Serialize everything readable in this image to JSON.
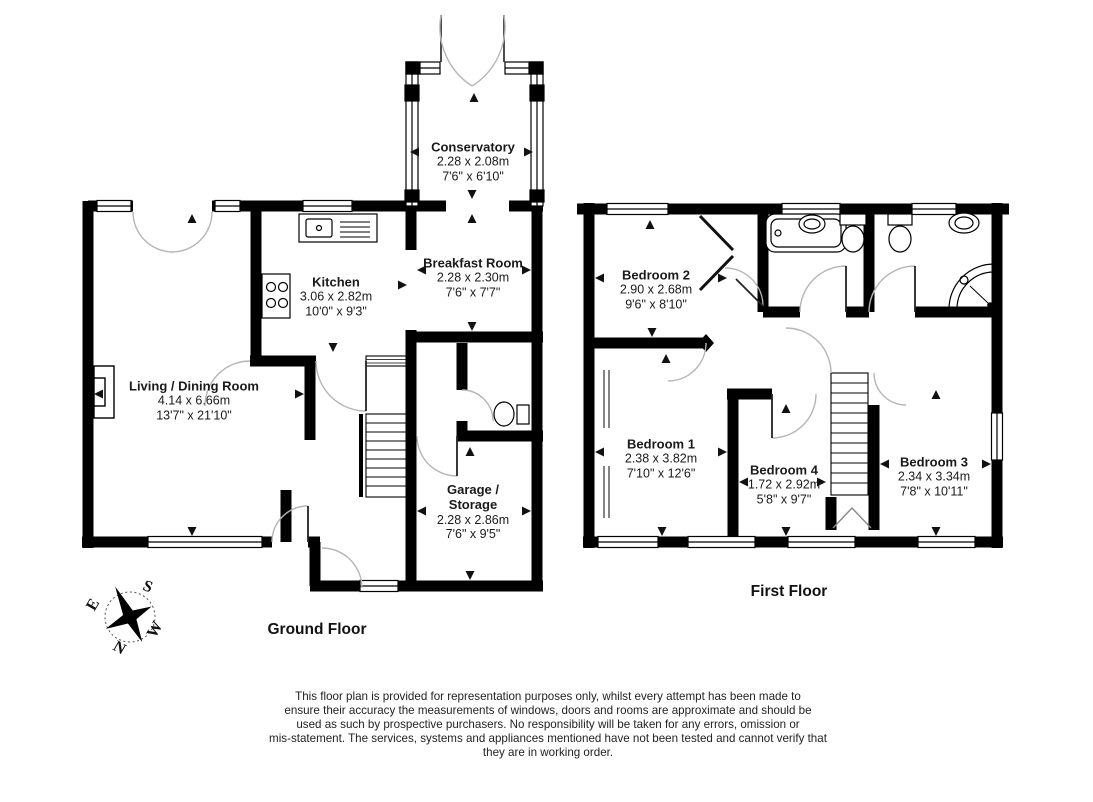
{
  "ground_floor": {
    "label": "Ground Floor",
    "rooms": {
      "living": {
        "name": "Living / Dining Room",
        "metric": "4.14 x 6.66m",
        "imperial": "13'7\" x 21'10\""
      },
      "kitchen": {
        "name": "Kitchen",
        "metric": "3.06 x 2.82m",
        "imperial": "10'0\" x 9'3\""
      },
      "breakfast": {
        "name": "Breakfast Room",
        "metric": "2.28 x 2.30m",
        "imperial": "7'6\" x 7'7\""
      },
      "conservatory": {
        "name": "Conservatory",
        "metric": "2.28 x 2.08m",
        "imperial": "7'6\" x 6'10\""
      },
      "garage": {
        "name": "Garage /\nStorage",
        "metric": "2.28 x 2.86m",
        "imperial": "7'6\" x 9'5\""
      }
    }
  },
  "first_floor": {
    "label": "First Floor",
    "rooms": {
      "bedroom1": {
        "name": "Bedroom 1",
        "metric": "2.38 x 3.82m",
        "imperial": "7'10\" x 12'6\""
      },
      "bedroom2": {
        "name": "Bedroom 2",
        "metric": "2.90 x 2.68m",
        "imperial": "9'6\" x 8'10\""
      },
      "bedroom3": {
        "name": "Bedroom 3",
        "metric": "2.34 x 3.34m",
        "imperial": "7'8\" x 10'11\""
      },
      "bedroom4": {
        "name": "Bedroom 4",
        "metric": "1.72 x 2.92m",
        "imperial": "5'8\" x 9'7\""
      }
    }
  },
  "compass": {
    "north": "N",
    "south": "S",
    "east": "E",
    "west": "W"
  },
  "disclaimer": "This floor plan is provided for representation purposes only, whilst every attempt has been made to\nensure their accuracy the measurements of windows, doors and rooms are approximate and should be\nused as such by prospective purchasers. No responsibility will be taken for any errors, omission or\nmis-statement. The services, systems and appliances mentioned have not been tested and cannot verify that\nthey are in working order.",
  "colors": {
    "wall": "#000000",
    "door_arc": "#b5b5b5",
    "text": "#1a1a1a"
  }
}
